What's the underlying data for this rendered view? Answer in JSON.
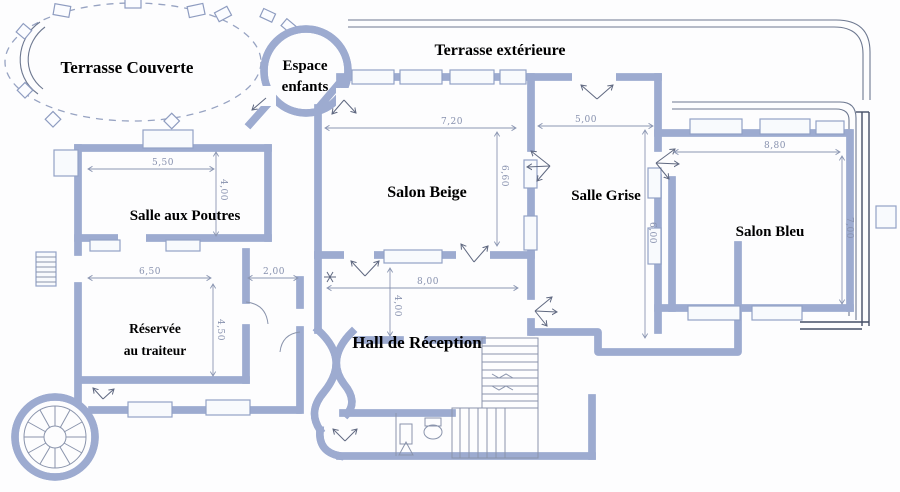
{
  "document": {
    "type": "scanned architectural floor plan",
    "language": "fr"
  },
  "rooms": {
    "terrasse_couverte": {
      "label": "Terrasse Couverte"
    },
    "espace_enfants": {
      "line1": "Espace",
      "line2": "enfants"
    },
    "terrasse_exterieure": {
      "label": "Terrasse extérieure"
    },
    "salle_aux_poutres": {
      "label": "Salle aux Poutres"
    },
    "salon_beige": {
      "label": "Salon Beige"
    },
    "salle_grise": {
      "label": "Salle Grise"
    },
    "salon_bleu": {
      "label": "Salon Bleu"
    },
    "reservee_traiteur": {
      "line1": "Réservée",
      "line2": "au traiteur"
    },
    "hall_reception": {
      "label": "Hall de Réception"
    }
  },
  "dimensions": {
    "salle_aux_poutres_width": "5,50",
    "salle_aux_poutres_depth": "4,00",
    "reservee_width": "6,50",
    "passage_width": "2,00",
    "reservee_depth": "4,50",
    "salon_beige_width": "7,20",
    "salon_beige_depth": "6,60",
    "salle_grise_width": "5,00",
    "salle_grise_depth": "6,00",
    "salon_bleu_width": "8,80",
    "salon_bleu_depth": "7,00",
    "hall_width": "8,00",
    "hall_depth": "4,00"
  },
  "colors": {
    "background": "#fdfdfe",
    "wall_outline": "#9dabd0",
    "wall_fill": "#e6ebf6",
    "scan_line": "#6d7890",
    "glazing_dark": "#454e66",
    "dimension": "#8791ae",
    "label": "#000000"
  },
  "icons": {
    "spiral_staircase": "circle-with-radial-spokes",
    "staircase": "parallel-tread-lines",
    "toilet": "oval-bowl-with-tank",
    "door_swing": "arrow-fan",
    "terrace_column": "small-square-pier"
  }
}
